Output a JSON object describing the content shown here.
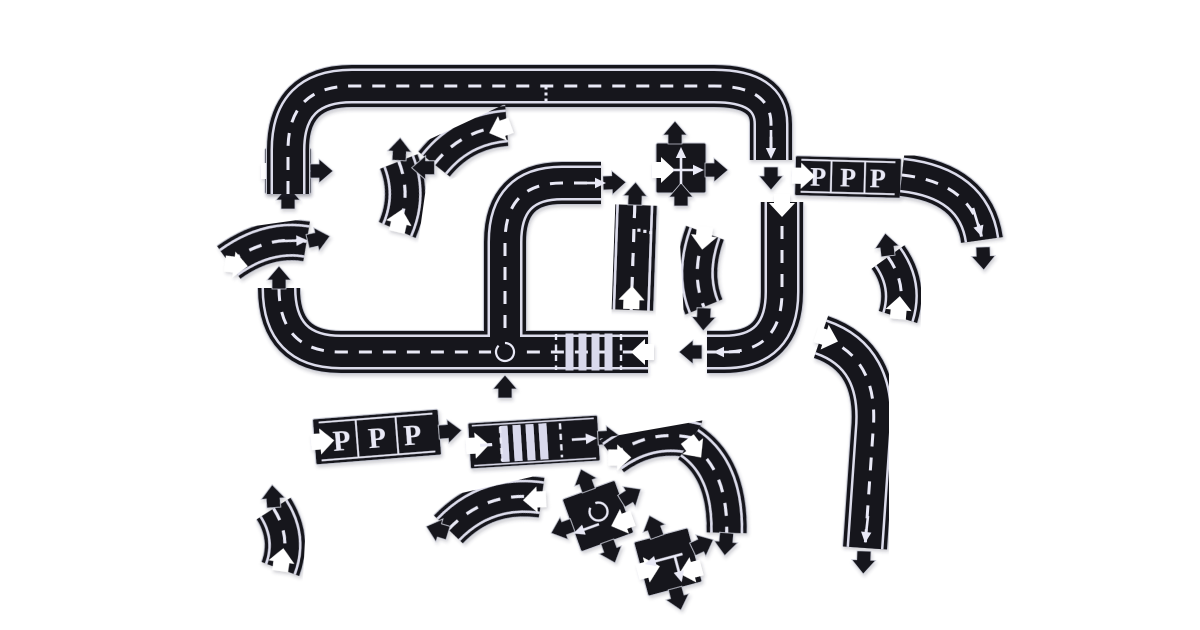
{
  "scene": {
    "description": "toy-road-puzzle-set-product-photo",
    "width": 1200,
    "height": 630,
    "colors": {
      "bg": "#ffffff",
      "road": "#17171f",
      "rim": "#c6c8d3",
      "edge": "#dcdceb",
      "marking": "#e9e9f6",
      "zebra": "#d9d9ec"
    },
    "pieces": [
      {
        "name": "t-junction-end-piece",
        "type": "cross",
        "x": 288,
        "y": 171,
        "rot": 0,
        "s": 46,
        "tabs": [
          {
            "x": 23,
            "y": 0,
            "dir": 0
          },
          {
            "x": 0,
            "y": 37,
            "dir": -90
          }
        ],
        "notches": [
          {
            "x": -25,
            "y": 0,
            "dir": 0
          }
        ],
        "marks": [
          {
            "t": "arrow",
            "x1": 0,
            "y1": 16,
            "x2": 0,
            "y2": -14
          },
          {
            "t": "arrow",
            "x1": -10,
            "y1": 0,
            "x2": 14,
            "y2": 0
          }
        ]
      },
      {
        "name": "top-loop-track",
        "type": "road",
        "x": 0,
        "y": 0,
        "rot": 0,
        "w": 42,
        "d": "M288,194 L288,150 Q288,86 352,86 L714,86 Q771,86 771,124 L771,160",
        "dash": true,
        "edges": true,
        "tabs": [
          {
            "x": 771,
            "y": 168,
            "dir": 90
          }
        ],
        "notches": [],
        "marks": [
          {
            "t": "dots",
            "pts": [
              [
                546,
                88
              ],
              [
                546,
                94
              ],
              [
                546,
                100
              ]
            ]
          },
          {
            "t": "arrow",
            "x1": 771,
            "y1": 130,
            "x2": 771,
            "y2": 150
          }
        ]
      },
      {
        "name": "parking-strip-top",
        "type": "parking",
        "x": 848,
        "y": 177,
        "rot": 1.5,
        "w": 106,
        "h": 40,
        "labels": [
          "P",
          "P",
          "P"
        ],
        "notches": [
          {
            "x": -54,
            "y": 0,
            "dir": 0
          }
        ],
        "tabs": []
      },
      {
        "name": "curve-from-parking",
        "type": "road",
        "x": 0,
        "y": 0,
        "rot": 0,
        "w": 42,
        "d": "M902,175 Q974,183 982,240",
        "dash": true,
        "edges": true,
        "tabs": [
          {
            "x": 983,
            "y": 248,
            "dir": 88
          }
        ],
        "notches": [],
        "marks": [
          {
            "t": "arrow",
            "x1": 973,
            "y1": 208,
            "x2": 979,
            "y2": 228
          }
        ]
      },
      {
        "name": "j-curve-track",
        "type": "road",
        "x": 0,
        "y": 0,
        "rot": 0,
        "w": 42,
        "d": "M782,202 L782,292 Q782,352 724,352 L707,352",
        "dash": true,
        "edges": true,
        "tabs": [
          {
            "x": 701,
            "y": 352,
            "dir": 180
          }
        ],
        "notches": [
          {
            "x": 782,
            "y": 196,
            "dir": 90
          }
        ],
        "marks": [
          {
            "t": "arrow",
            "x1": 740,
            "y1": 352,
            "x2": 722,
            "y2": 352
          }
        ]
      },
      {
        "name": "main-track-roundabout-crosswalk",
        "type": "road",
        "x": 0,
        "y": 0,
        "rot": 0,
        "w": 42,
        "d": "M279,288 Q279,352 341,352 L648,352 M505,352 L505,242 Q505,183 562,183 L601,183",
        "dash": true,
        "edges": true,
        "tabs": [
          {
            "x": 279,
            "y": 288,
            "dir": -90
          },
          {
            "x": 505,
            "y": 397,
            "dir": -90
          },
          {
            "x": 604,
            "y": 183,
            "dir": -2
          }
        ],
        "notches": [
          {
            "x": 652,
            "y": 352,
            "dir": 180
          }
        ],
        "marks": [
          {
            "t": "zebra",
            "cx": 589,
            "cy": 352,
            "n": 4,
            "step": 13,
            "bw": 8,
            "bh": 37
          },
          {
            "t": "stopdash",
            "x": 556,
            "y1": 334,
            "y2": 370
          },
          {
            "t": "stopdash",
            "x": 621,
            "y1": 334,
            "y2": 370
          },
          {
            "t": "circle",
            "x": 505,
            "y": 352,
            "r": 9
          },
          {
            "t": "arrow",
            "x1": 581,
            "y1": 183,
            "x2": 597,
            "y2": 183
          }
        ]
      },
      {
        "name": "straight-road-piece",
        "type": "road",
        "x": 633,
        "y": 257,
        "rot": 2,
        "w": 44,
        "d": "M0,-52 L0,53",
        "dash": true,
        "edges": true,
        "tabs": [
          {
            "x": 0,
            "y": -53,
            "dir": -90
          }
        ],
        "notches": [
          {
            "x": 0,
            "y": 50,
            "dir": -90
          }
        ],
        "marks": [
          {
            "t": "dots",
            "pts": [
              [
                5,
                -27
              ],
              [
                11,
                -26
              ],
              [
                17,
                -25
              ]
            ]
          }
        ]
      },
      {
        "name": "s-curve-piece",
        "type": "road",
        "x": 702,
        "y": 271,
        "rot": -3,
        "w": 40,
        "d": "M5,-38 Q-12,2 0,36",
        "dash": true,
        "edges": true,
        "tabs": [
          {
            "x": 0,
            "y": 38,
            "dir": 95
          }
        ],
        "notches": [
          {
            "x": 5,
            "y": -42,
            "dir": 100
          }
        ]
      },
      {
        "name": "short-curve-piece-right",
        "type": "road",
        "x": 900,
        "y": 287,
        "rot": 0,
        "w": 40,
        "d": "M-12,-30 Q8,-2 -2,30",
        "dash": true,
        "edges": true,
        "tabs": [
          {
            "x": -12,
            "y": -32,
            "dir": -97
          }
        ],
        "notches": [
          {
            "x": -2,
            "y": 30,
            "dir": -85
          }
        ]
      },
      {
        "name": "long-curve-track-right",
        "type": "road",
        "x": 0,
        "y": 0,
        "rot": 0,
        "w": 44,
        "d": "M821,337 Q880,357 873,432 L865,548",
        "dash": true,
        "edges": true,
        "tabs": [
          {
            "x": 864,
            "y": 552,
            "dir": 92
          }
        ],
        "notches": [
          {
            "x": 818,
            "y": 335,
            "dir": 18
          }
        ],
        "marks": [
          {
            "t": "arrow",
            "x1": 868,
            "y1": 516,
            "x2": 866,
            "y2": 534
          }
        ]
      },
      {
        "name": "parking-strip-bottom",
        "type": "parking",
        "x": 377,
        "y": 437,
        "rot": -4.5,
        "w": 126,
        "h": 46,
        "labels": [
          "P",
          "P",
          "P"
        ],
        "notches": [
          {
            "x": -64,
            "y": 0,
            "dir": 0
          }
        ],
        "tabs": [
          {
            "x": 63,
            "y": 0,
            "dir": 0
          }
        ]
      },
      {
        "name": "crosswalk-piece",
        "type": "crosswalk",
        "x": 534,
        "y": 442,
        "rot": -3.5,
        "w": 130,
        "h": 46,
        "notches": [
          {
            "x": -66,
            "y": 0,
            "dir": 0
          }
        ],
        "tabs": [
          {
            "x": 65,
            "y": 0,
            "dir": 0
          }
        ],
        "zebra": {
          "cx": -10,
          "cy": 0,
          "n": 4,
          "step": 13,
          "bw": 8,
          "bh": 36
        },
        "marks": [
          {
            "t": "stopdash",
            "x": -33,
            "y1": -17,
            "y2": 17
          },
          {
            "t": "stopdash",
            "x": 27,
            "y1": -17,
            "y2": 17
          },
          {
            "t": "dashseg",
            "x1": -54,
            "y1": 0,
            "x2": -42,
            "y2": 0
          },
          {
            "t": "arrow",
            "x1": 38,
            "y1": 0,
            "x2": 54,
            "y2": 0
          }
        ]
      },
      {
        "name": "wide-curve-piece",
        "type": "road",
        "x": 492,
        "y": 505,
        "rot": -13,
        "w": 40,
        "d": "M-48,14 Q-2,-16 50,4",
        "dash": true,
        "edges": true,
        "tabs": [
          {
            "x": -50,
            "y": 17,
            "dir": 210
          }
        ],
        "notches": [
          {
            "x": 52,
            "y": 6,
            "dir": 190
          }
        ]
      },
      {
        "name": "roundabout-cross-piece",
        "type": "cross",
        "x": 598,
        "y": 516,
        "rot": -20,
        "s": 56,
        "tabs": [
          {
            "x": 0,
            "y": -28,
            "dir": -90
          },
          {
            "x": -28,
            "y": 0,
            "dir": 180
          },
          {
            "x": 0,
            "y": 28,
            "dir": 90
          },
          {
            "x": 28,
            "y": -6,
            "dir": -12
          }
        ],
        "notches": [
          {
            "x": 30,
            "y": 14,
            "dir": 180
          }
        ],
        "marks": [
          {
            "t": "circle",
            "x": 2,
            "y": -4,
            "r": 9
          },
          {
            "t": "arrow",
            "x1": -2,
            "y1": 8,
            "x2": -20,
            "y2": 8
          }
        ]
      },
      {
        "name": "intersection-cross-piece-bottom",
        "type": "cross",
        "x": 668,
        "y": 562,
        "rot": -15,
        "s": 56,
        "tabs": [
          {
            "x": -4,
            "y": -28,
            "dir": -95
          },
          {
            "x": 28,
            "y": -6,
            "dir": -10
          },
          {
            "x": 0,
            "y": 28,
            "dir": 90
          }
        ],
        "notches": [
          {
            "x": -30,
            "y": 2,
            "dir": 0
          },
          {
            "x": 29,
            "y": 14,
            "dir": 180
          }
        ],
        "marks": [
          {
            "t": "arrow",
            "x1": 16,
            "y1": -4,
            "x2": -14,
            "y2": -4
          },
          {
            "t": "arrow",
            "x1": 8,
            "y1": -4,
            "x2": 8,
            "y2": 14
          }
        ]
      },
      {
        "name": "short-curve-piece-bottom-left",
        "type": "road",
        "x": 281,
        "y": 539,
        "rot": 3,
        "w": 40,
        "d": "M-9,-30 Q11,-2 1,30",
        "dash": true,
        "edges": true,
        "tabs": [
          {
            "x": -9,
            "y": -32,
            "dir": -97
          }
        ],
        "notches": [
          {
            "x": 1,
            "y": 30,
            "dir": -85
          }
        ]
      },
      {
        "name": "shallow-curve-piece-left",
        "type": "road",
        "x": 267,
        "y": 247,
        "rot": -8,
        "w": 40,
        "d": "M-40,10 Q2,-12 40,0",
        "dash": true,
        "edges": true,
        "tabs": [
          {
            "x": 42,
            "y": 0,
            "dir": -5
          }
        ],
        "notches": [
          {
            "x": -42,
            "y": 11,
            "dir": 15
          }
        ],
        "marks": [
          {
            "t": "arrow",
            "x1": 14,
            "y1": -4,
            "x2": 32,
            "y2": -2
          }
        ]
      },
      {
        "name": "curve-piece-upper-left",
        "type": "road",
        "x": 400,
        "y": 196,
        "rot": 8,
        "w": 40,
        "d": "M-6,-34 Q12,-2 2,34",
        "dash": true,
        "edges": true,
        "tabs": [
          {
            "x": -6,
            "y": -36,
            "dir": -95
          }
        ],
        "notches": [
          {
            "x": 2,
            "y": 34,
            "dir": -85
          }
        ]
      },
      {
        "name": "curve-piece-top-middle",
        "type": "road",
        "x": 467,
        "y": 140,
        "rot": -25,
        "w": 40,
        "d": "M-40,8 Q0,-12 42,4",
        "dash": true,
        "edges": true,
        "tabs": [
          {
            "x": -42,
            "y": 11,
            "dir": 205
          }
        ],
        "notches": [
          {
            "x": 44,
            "y": 5,
            "dir": 185
          }
        ]
      },
      {
        "name": "intersection-piece-top-right",
        "type": "cross",
        "x": 681,
        "y": 168,
        "rot": 0,
        "s": 50,
        "tabs": [
          {
            "x": -6,
            "y": -25,
            "dir": -90
          },
          {
            "x": 25,
            "y": 2,
            "dir": 0
          },
          {
            "x": 0,
            "y": 37,
            "dir": -90
          }
        ],
        "notches": [
          {
            "x": -27,
            "y": 2,
            "dir": 0
          }
        ],
        "marks": [
          {
            "t": "arrow",
            "x1": 0,
            "y1": 16,
            "x2": 0,
            "y2": -12
          },
          {
            "t": "arrow",
            "x1": -8,
            "y1": 2,
            "x2": 14,
            "y2": 2
          }
        ]
      },
      {
        "name": "curve-piece-mid-right",
        "type": "road",
        "x": 652,
        "y": 441,
        "rot": -10,
        "w": 40,
        "d": "M-42,8 Q2,-14 45,6",
        "dash": true,
        "edges": true,
        "tabs": [
          {
            "x": 46,
            "y": 8,
            "dir": 35
          }
        ],
        "notches": [
          {
            "x": -44,
            "y": 9,
            "dir": 10
          }
        ]
      },
      {
        "name": "curve-piece-lower-right",
        "type": "road",
        "x": 713,
        "y": 488,
        "rot": 3,
        "w": 40,
        "d": "M-26,-44 Q14,-20 16,44",
        "dash": true,
        "edges": true,
        "tabs": [
          {
            "x": 16,
            "y": 45,
            "dir": 92
          }
        ],
        "notches": [
          {
            "x": -27,
            "y": -46,
            "dir": 50
          }
        ]
      }
    ]
  }
}
